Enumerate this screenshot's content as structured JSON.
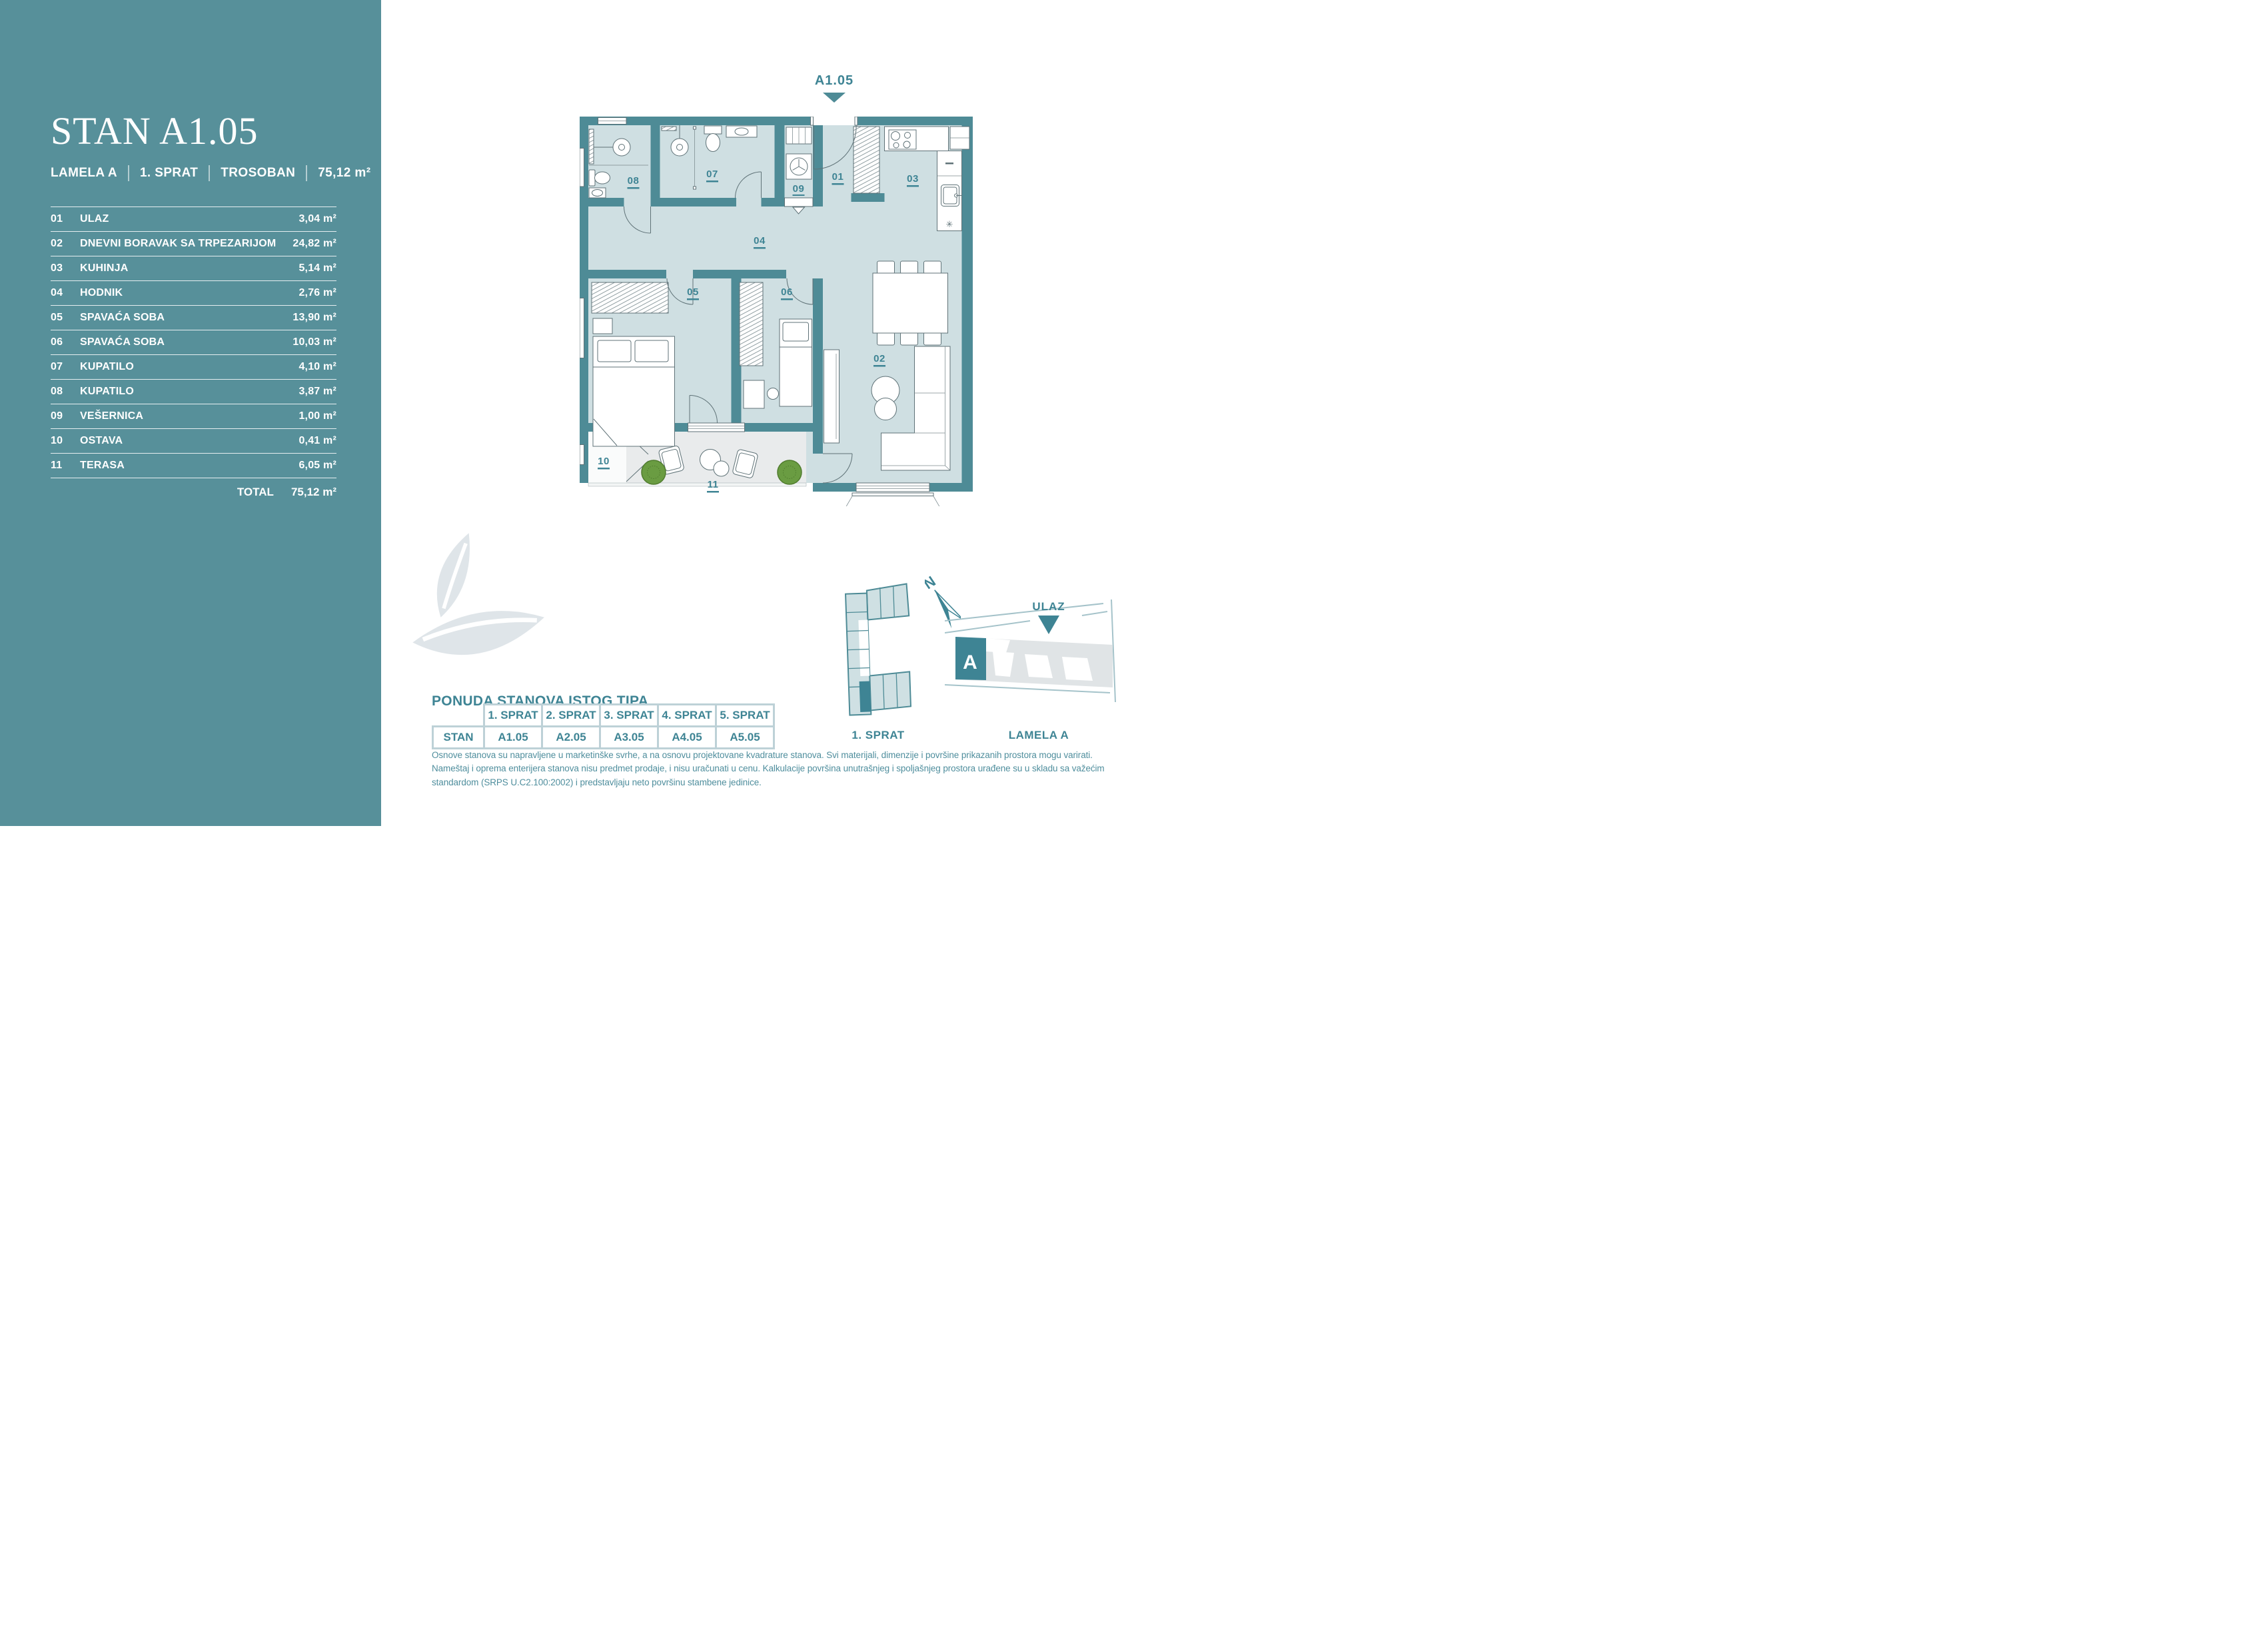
{
  "colors": {
    "sidebar_teal": "#57909a",
    "wall_teal": "#4e8b96",
    "floor": "#cfdfe2",
    "terrace": "#e9ebec",
    "accent_teal": "#3e8494",
    "table_border": "#bdd1d7",
    "leaf_gray": "#dfe5e9",
    "plant_green": "#6a9c42"
  },
  "sidebar": {
    "title": "STAN A1.05",
    "meta": [
      "LAMELA A",
      "1. SPRAT",
      "TROSOBAN",
      "75,12 m²"
    ],
    "rooms": [
      {
        "num": "01",
        "name": "ULAZ",
        "area": "3,04 m²"
      },
      {
        "num": "02",
        "name": "DNEVNI BORAVAK SA TRPEZARIJOM",
        "area": "24,82 m²"
      },
      {
        "num": "03",
        "name": "KUHINJA",
        "area": "5,14 m²"
      },
      {
        "num": "04",
        "name": "HODNIK",
        "area": "2,76 m²"
      },
      {
        "num": "05",
        "name": "SPAVAĆA SOBA",
        "area": "13,90 m²"
      },
      {
        "num": "06",
        "name": "SPAVAĆA SOBA",
        "area": "10,03 m²"
      },
      {
        "num": "07",
        "name": "KUPATILO",
        "area": "4,10 m²"
      },
      {
        "num": "08",
        "name": "KUPATILO",
        "area": "3,87 m²"
      },
      {
        "num": "09",
        "name": "VEŠERNICA",
        "area": "1,00 m²"
      },
      {
        "num": "10",
        "name": "OSTAVA",
        "area": "0,41 m²"
      },
      {
        "num": "11",
        "name": "TERASA",
        "area": "6,05 m²"
      }
    ],
    "total_label": "TOTAL",
    "total_area": "75,12 m²"
  },
  "plan": {
    "unit_label": "A1.05",
    "rooms": {
      "r01": "01",
      "r02": "02",
      "r03": "03",
      "r04": "04",
      "r05": "05",
      "r06": "06",
      "r07": "07",
      "r08": "08",
      "r09": "09",
      "r10": "10",
      "r11": "11"
    },
    "symbols": {
      "star": "✳"
    }
  },
  "offer": {
    "heading": "PONUDA STANOVA ISTOG TIPA",
    "row_label": "STAN",
    "floors": [
      "1. SPRAT",
      "2. SPRAT",
      "3. SPRAT",
      "4. SPRAT",
      "5. SPRAT"
    ],
    "units": [
      "A1.05",
      "A2.05",
      "A3.05",
      "A4.05",
      "A5.05"
    ]
  },
  "siteplan": {
    "north_label": "N",
    "entrance_label": "ULAZ",
    "block_label": "A",
    "floor_caption": "1. SPRAT",
    "lamela_caption": "LAMELA A"
  },
  "disclaimer": "Osnove stanova su napravljene u marketinške svrhe, a na osnovu projektovane kvadrature stanova. Svi materijali, dimenzije i površine prikazanih prostora mogu varirati. Nameštaj i oprema enterijera stanova nisu predmet prodaje, i nisu uračunati u cenu. Kalkulacije površina unutrašnjeg i spoljašnjeg prostora urađene su u skladu sa važećim standardom (SRPS U.C2.100:2002) i predstavljaju neto površinu stambene jedinice."
}
